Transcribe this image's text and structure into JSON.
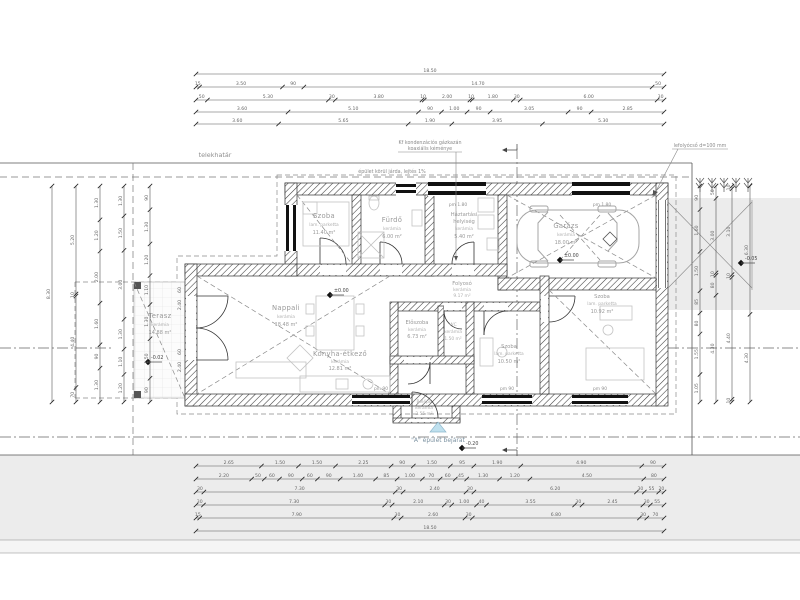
{
  "site": {
    "telekhatar_label": "telekhatár",
    "entrance_label": "\"A\" épület bejárat"
  },
  "notes": {
    "walkway": "épület körül járda, lejtés 1%",
    "boiler_line1": "Kf kondenzációs gázkazán",
    "boiler_line2": "koaxiális kéménye",
    "downpipe": "lefolyócső d=100 mm"
  },
  "elevations": {
    "zero": "±0.00",
    "garage_zero": "±0.00",
    "minus002": "-0.02",
    "minus005": "-0.05",
    "minus020": "-0.20"
  },
  "window_labels": {
    "top": "pm 1.80",
    "bottom": "pm 90"
  },
  "rooms": [
    {
      "name": "Szoba",
      "finish": "lam. parketta",
      "area": "11.40 m²"
    },
    {
      "name": "Fürdő",
      "finish": "kerámia",
      "area": "6.00 m²"
    },
    {
      "name_line1": "Háztartási",
      "name_line2": "helyiség",
      "finish": "kerámia",
      "area": "5.40 m²"
    },
    {
      "name": "Garázs",
      "finish": "kerámia",
      "area": "18.00 m²"
    },
    {
      "name": "Terasz",
      "finish": "kerámia",
      "area": "14.88 m²"
    },
    {
      "name": "Nappali",
      "finish": "kerámia",
      "area": "18.48 m²"
    },
    {
      "name": "Konyha-étkező",
      "finish": "kerámia",
      "area": "12.81 m²"
    },
    {
      "name": "Előszoba",
      "finish": "kerámia",
      "area": "6.73 m²"
    },
    {
      "name": "WC",
      "finish": "kerámia",
      "area": "1.50 m²"
    },
    {
      "name": "Folyosó",
      "finish": "kerámia",
      "area": "9.17 m²"
    },
    {
      "name": "Szoba",
      "finish": "lam. parketta",
      "area": "10.50 m²"
    },
    {
      "name": "Szoba",
      "finish": "lam. parketta",
      "area": "10.92 m²"
    },
    {
      "name": "Belépő",
      "finish": "kerámia",
      "area": "2.55 m²"
    }
  ],
  "dimensions": {
    "top": [
      [
        "18.50"
      ],
      [
        "15",
        "3.50",
        "90",
        "14.70",
        "50"
      ],
      [
        "50",
        "5.30",
        "30",
        "3.80",
        "10",
        "2.00",
        "10",
        "1.80",
        "30",
        "6.00",
        "30"
      ],
      [
        "3.60",
        "5.10",
        "90",
        "1.00",
        "90",
        "3.05",
        "90",
        "2.85"
      ],
      [
        "3.60",
        "5.65",
        "1.90",
        "3.95",
        "5.30"
      ]
    ],
    "bottom": [
      [
        "2.65",
        "1.50",
        "1.50",
        "2.25",
        "90",
        "1.50",
        "95",
        "1.90",
        "4.90",
        "90"
      ],
      [
        "2.20",
        "50",
        "60",
        "90",
        "60",
        "90",
        "1.40",
        "85",
        "1.00",
        "70",
        "60",
        "45",
        "1.30",
        "1.20",
        "4.50",
        "80"
      ],
      [
        "30",
        "7.30",
        "30",
        "2.40",
        "30",
        "6.20",
        "30",
        "55",
        "20"
      ],
      [
        "30",
        "7.30",
        "30",
        "2.10",
        "30",
        "1.00",
        "40",
        "3.55",
        "30",
        "2.45",
        "30",
        "55"
      ],
      [
        "15",
        "7.90",
        "30",
        "2.60",
        "30",
        "6.80",
        "30",
        "70"
      ],
      [
        "18.50"
      ]
    ],
    "left": [
      [
        "8.30"
      ],
      [
        "5.20",
        "10",
        "4.40",
        "70"
      ],
      [
        "1.30",
        "1.20",
        "2.00",
        "1.60",
        "90",
        "1.30"
      ],
      [
        "1.30",
        "1.50",
        "3.00",
        "1.30",
        "1.10",
        "1.20"
      ],
      [
        "90",
        "1.30",
        "1.20",
        "1.10",
        "1.30",
        "1.50",
        "90"
      ]
    ],
    "right": [
      [
        "90",
        "1.60",
        "1.50",
        "85",
        "80",
        "1.55",
        "1.05"
      ],
      [
        "50",
        "3.00",
        "10",
        "80",
        "4.30"
      ],
      [
        "10",
        "3.10",
        "10",
        "4.40",
        "10"
      ],
      [
        "6.30",
        "4.30"
      ]
    ],
    "wall_left": [
      "60",
      "2.40",
      "60",
      "2.40"
    ]
  }
}
